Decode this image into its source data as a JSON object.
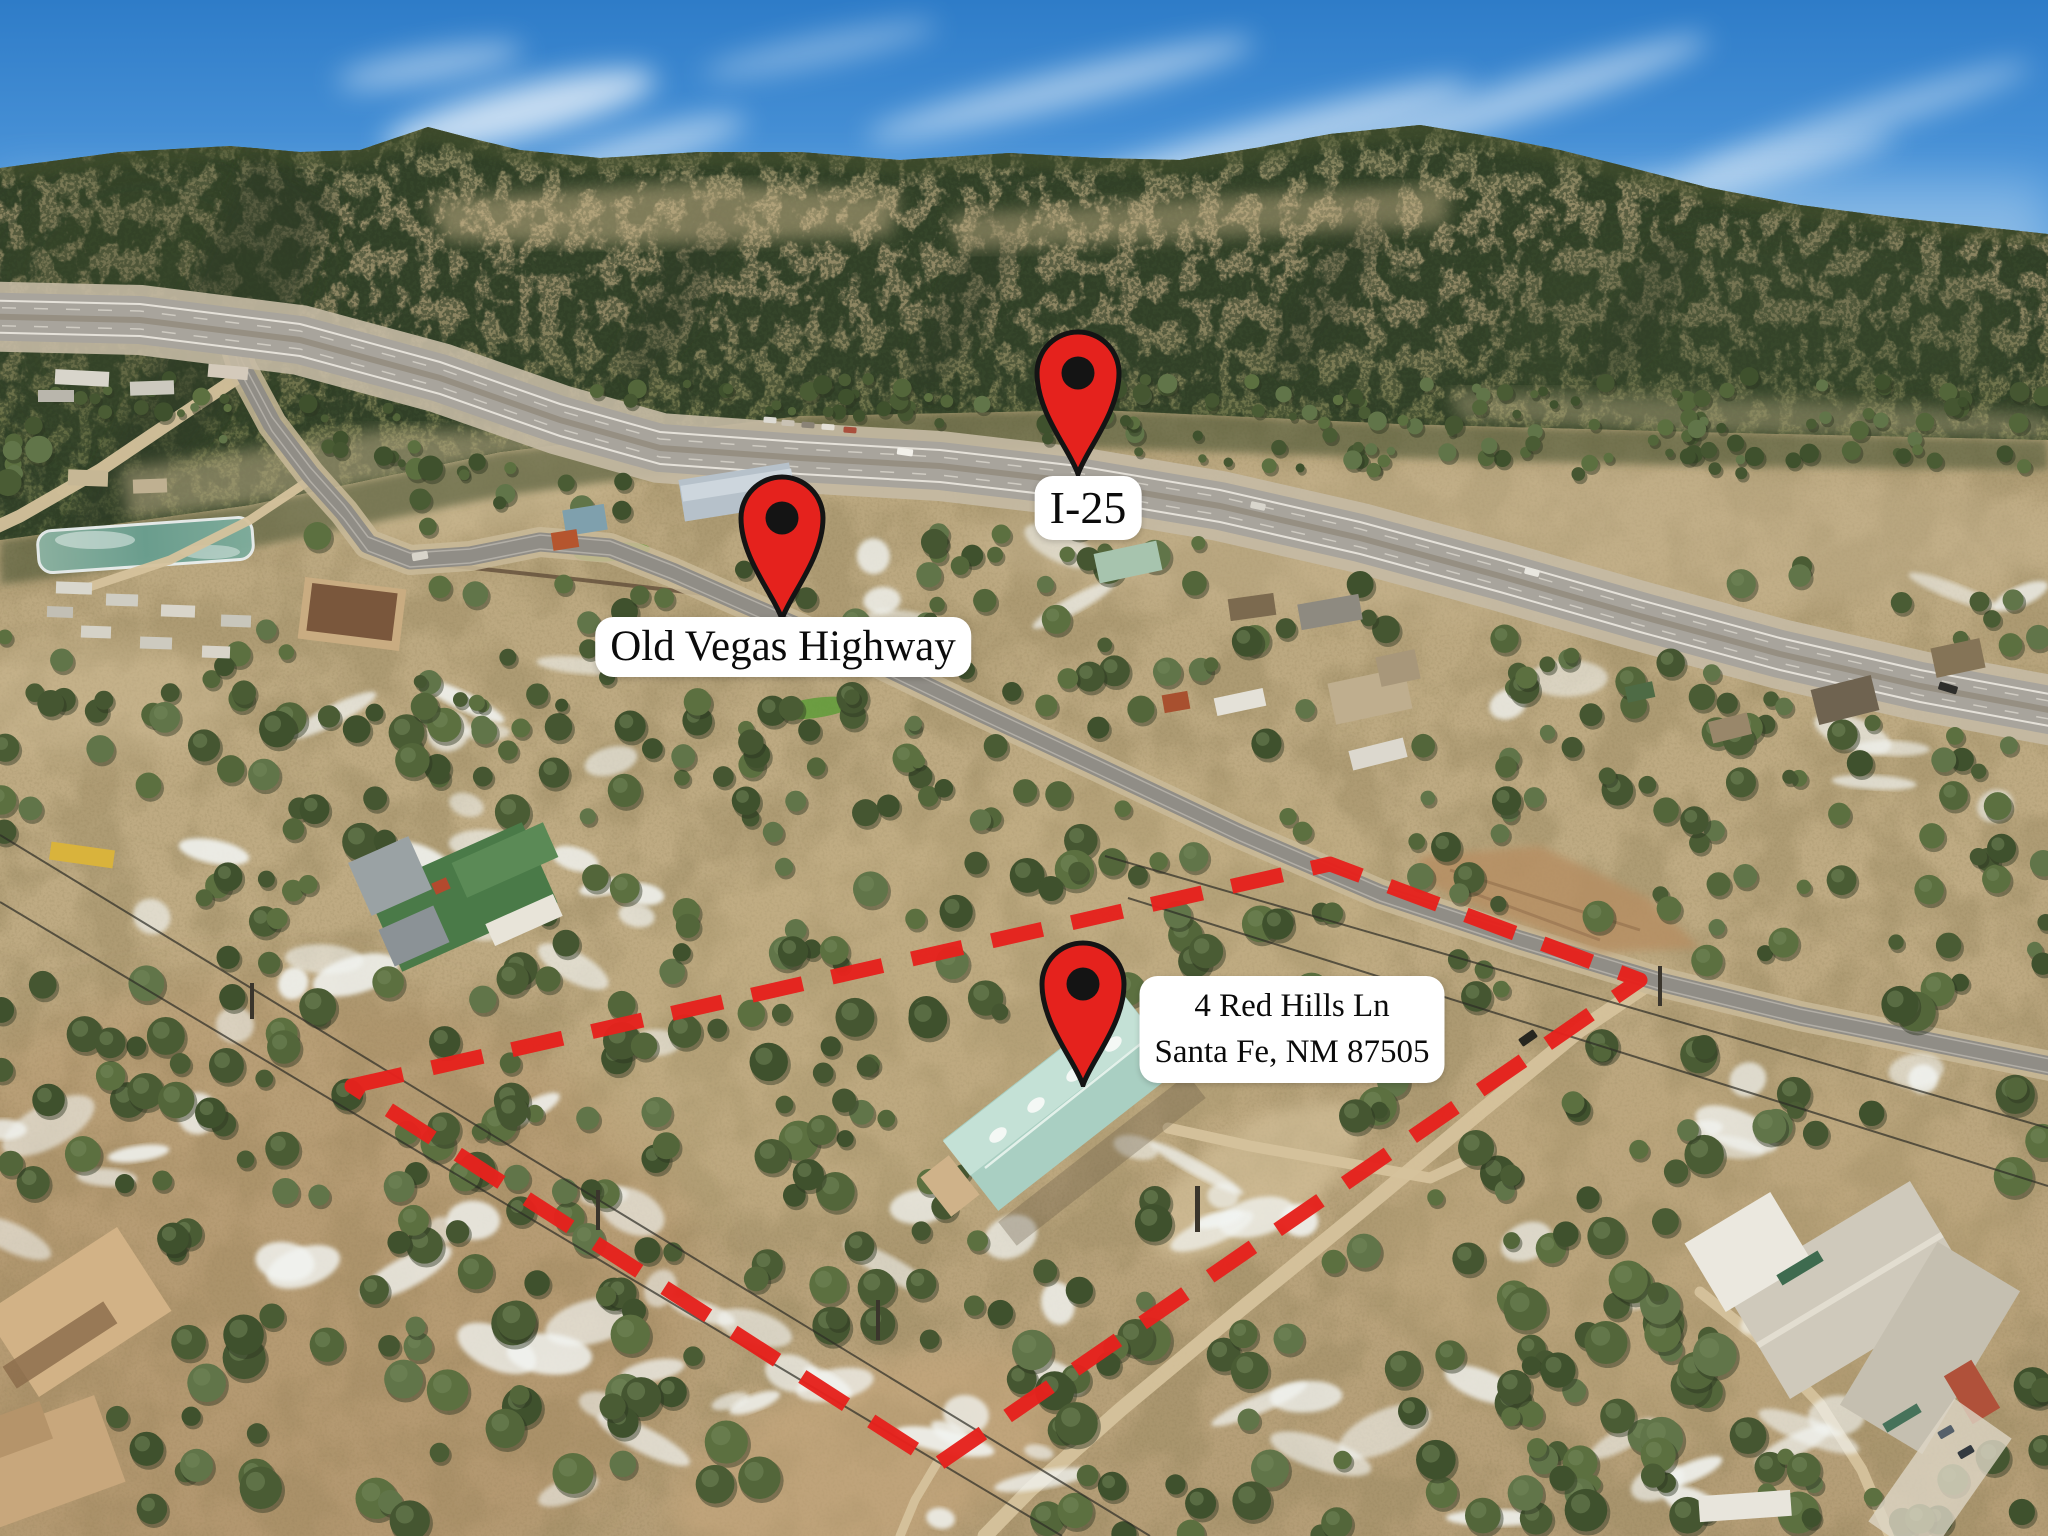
{
  "page": {
    "type": "annotated aerial real-estate photograph",
    "description": "Drone photo of a high-desert parcel with red dashed property boundary, location pins and road labels"
  },
  "colors": {
    "annotation_red": "#e5221d",
    "pin_outline": "#141414",
    "label_background": "#ffffff",
    "label_text": "#0b0b0b"
  },
  "annotations": {
    "pins": [
      {
        "id": "i25",
        "name": "I-25 location pin",
        "tip_x": 1078,
        "tip_y": 474
      },
      {
        "id": "old-vegas-highway",
        "name": "Old Vegas Highway location pin",
        "tip_x": 782,
        "tip_y": 619
      },
      {
        "id": "property",
        "name": "Subject property location pin",
        "tip_x": 1083,
        "tip_y": 1085
      }
    ],
    "labels": [
      {
        "id": "i25",
        "lines": [
          "I-25"
        ],
        "cx": 1088,
        "top": 476,
        "font_px": 46
      },
      {
        "id": "old-vegas-highway",
        "lines": [
          "Old Vegas Highway"
        ],
        "cx": 783,
        "top": 617,
        "font_px": 43
      },
      {
        "id": "property",
        "lines": [
          "4 Red Hills Ln",
          "Santa Fe, NM 87505"
        ],
        "cx": 1292,
        "top": 976,
        "font_px": 33
      }
    ],
    "property_boundary": {
      "stroke_width": 15,
      "dash_on": 52,
      "dash_off": 30,
      "points": [
        [
          352,
          1086
        ],
        [
          1330,
          864
        ],
        [
          1640,
          980
        ],
        [
          938,
          1464
        ]
      ]
    }
  }
}
